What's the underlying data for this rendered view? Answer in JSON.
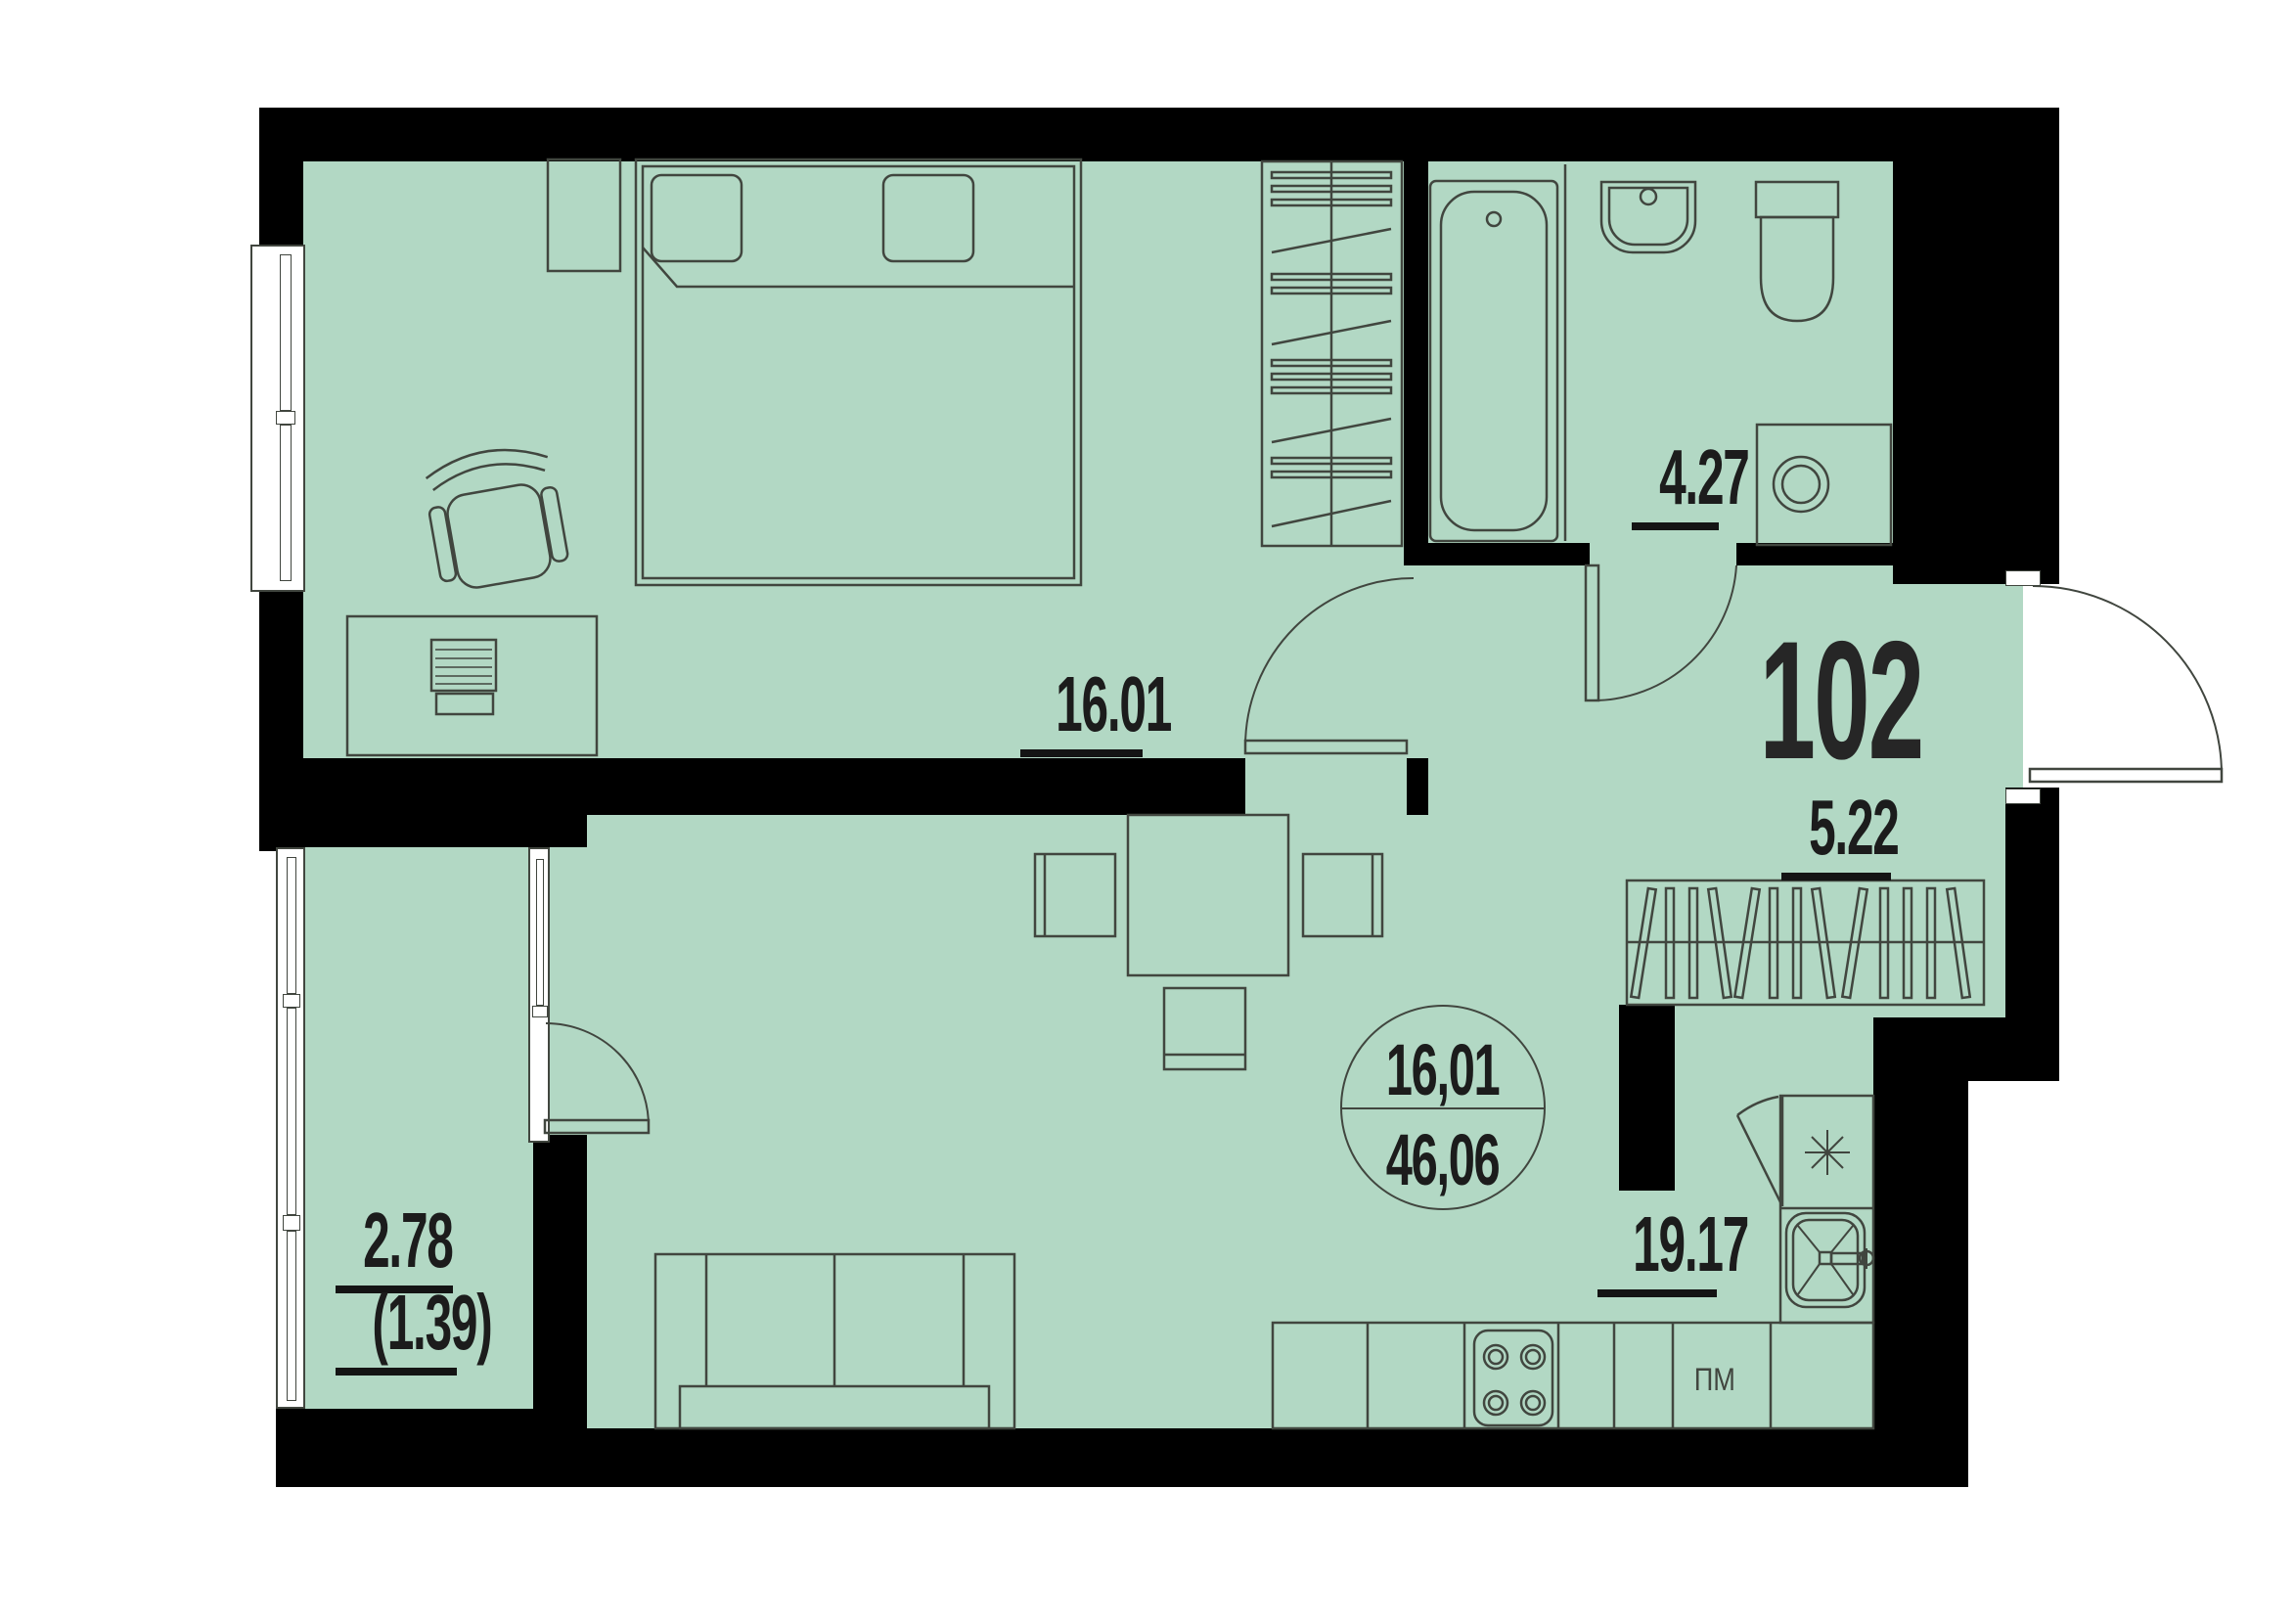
{
  "apartment_number": "102",
  "area_circle": {
    "top": "16,01",
    "bottom": "46,06"
  },
  "rooms": {
    "bedroom": {
      "label": "16.01"
    },
    "bathroom": {
      "label": "4.27"
    },
    "hallway": {
      "label": "5.22"
    },
    "kitchen_living": {
      "label": "19.17"
    },
    "balcony": {
      "label": "2.78",
      "label_secondary": "(1.39)"
    }
  },
  "appliances": {
    "dishwasher": "ПМ"
  },
  "colors": {
    "floor": "#b2d8c4",
    "wall": "#000000",
    "line": "#41463f",
    "text": "#1c1c1c"
  }
}
